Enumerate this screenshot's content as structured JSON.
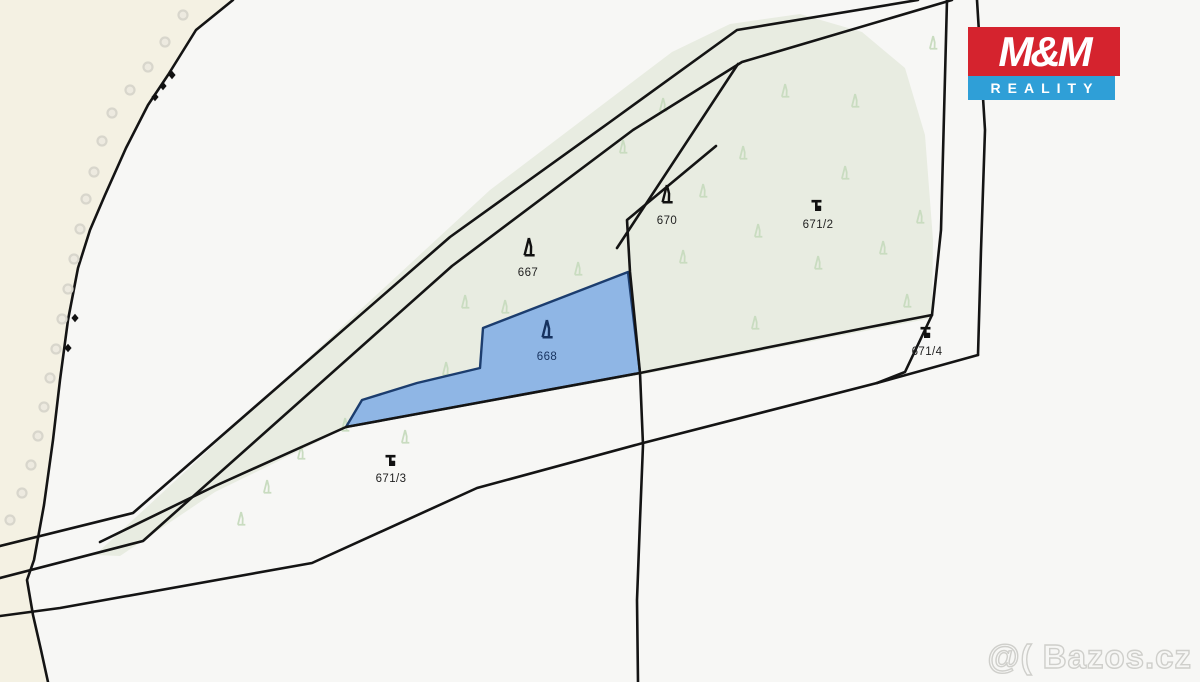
{
  "branding": {
    "logo_line1": "M&M",
    "logo_line2": "REALITY",
    "logo_red_color": "#d5232e",
    "logo_blue_color": "#2f9fd7"
  },
  "watermark": {
    "text": "@( Bazos.cz"
  },
  "map": {
    "type": "cadastral-map",
    "highlight_color": "#8fb6e5",
    "highlight_border_color": "#1c3d6e",
    "forest_fill_color": "#e8ece1",
    "cream_fill_color": "#f4f1e3",
    "boundary_line_color": "#141414",
    "parcels": [
      {
        "number": "667",
        "symbol": "conifer-tree",
        "highlighted": false
      },
      {
        "number": "668",
        "symbol": "conifer-tree",
        "highlighted": true
      },
      {
        "number": "670",
        "symbol": "conifer-tree",
        "highlighted": false
      },
      {
        "number": "671/2",
        "symbol": "grassland",
        "highlighted": false
      },
      {
        "number": "671/3",
        "symbol": "grassland",
        "highlighted": false
      },
      {
        "number": "671/4",
        "symbol": "grassland",
        "highlighted": false
      }
    ]
  }
}
